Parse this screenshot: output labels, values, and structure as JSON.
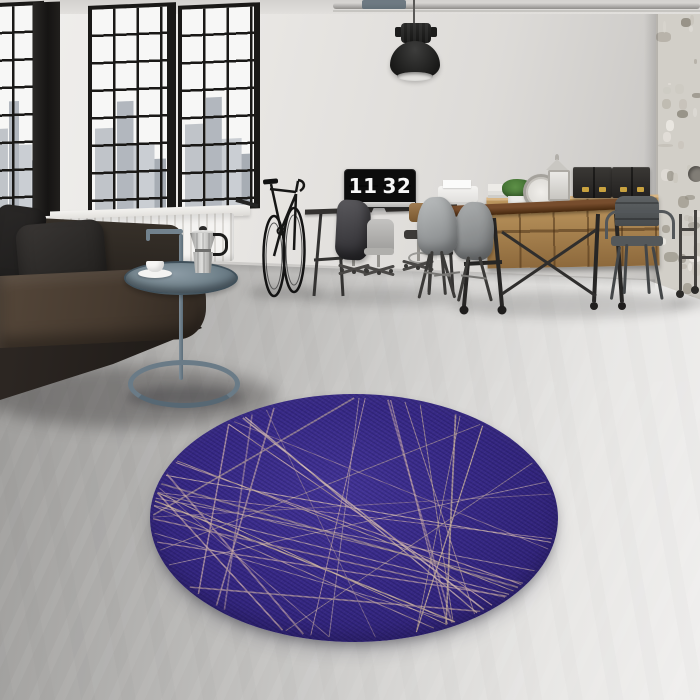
{
  "scene": {
    "description": "Industrial loft interior with black-framed windows, dark leather sofa, side table with moka pot, workstation monitor showing a flip clock, bicycle, wooden dining set, sideboard with brass-cornered boxes, pendant lamp and a round purple rug on a concrete floor",
    "monitor": {
      "hours": "11",
      "minutes": "32"
    }
  },
  "palette": {
    "rug_base": "#382a87",
    "rug_shade": "#2c2070",
    "rug_line_pink": "#c4a6ab",
    "rug_line_tan": "#ccb49f",
    "rug_line_mauve": "#aa919e",
    "rug_line_light": "#d8bfb4",
    "wall": "#e7e5e2",
    "floor_dark": "#a09f9d",
    "floor_light": "#edecea",
    "sofa_leather": "#453a30",
    "side_table_metal": "#74858f",
    "table_wood": "#6b4429",
    "sideboard_wood": "#b08e58",
    "brass_accent": "#c9a23f",
    "window_frame": "#1a1917"
  }
}
